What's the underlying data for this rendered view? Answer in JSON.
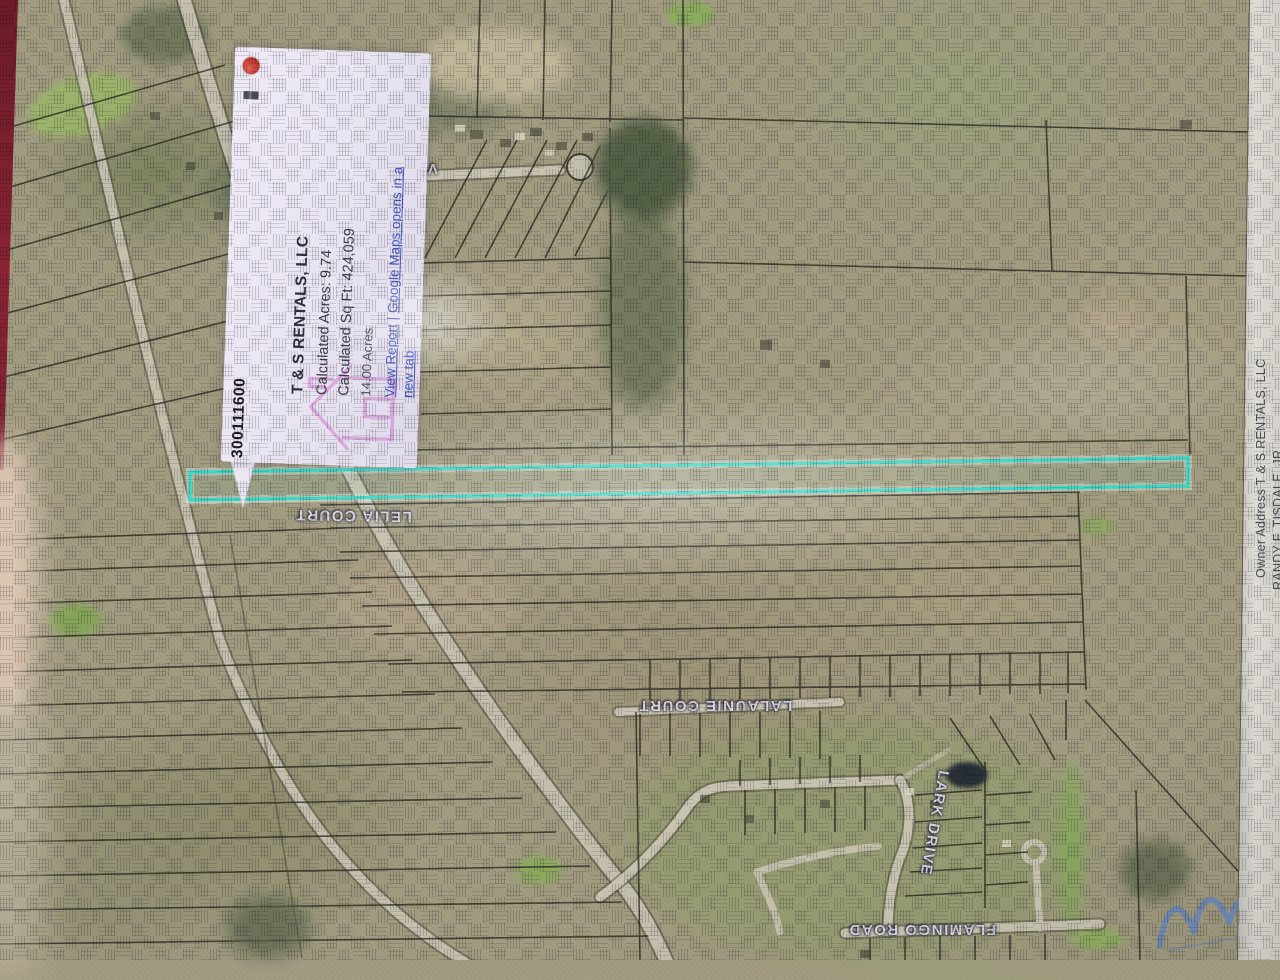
{
  "popup": {
    "parcel_number": "300111600",
    "title": "T & S RENTALS, LLC",
    "calculated_acres": "Calculated Acres: 9.74",
    "calculated_sqft": "Calculated Sq Ft: 424,059",
    "deeded_acres": "14.00 Acres",
    "view_report": "View Report",
    "separator": "|",
    "google_maps": "Google Maps opens in a new tab"
  },
  "labels": {
    "road_ve": "VE",
    "lelia_court": "LELIA COURT",
    "lalaunie_court": "LALAUNIE COURT",
    "lark_drive": "LARK DRIVE",
    "flamingo_road": "FLAMINGO ROAD"
  },
  "owner_strip": {
    "line1": "Owner Address  T & S RENTALS, LLC",
    "line2": "RANDY F. TISDALE, JR."
  },
  "colors": {
    "selected_parcel": "#38d8c6",
    "popup_background": "#eae6f2",
    "close_button": "#c23a30",
    "link": "#3d55c4"
  }
}
